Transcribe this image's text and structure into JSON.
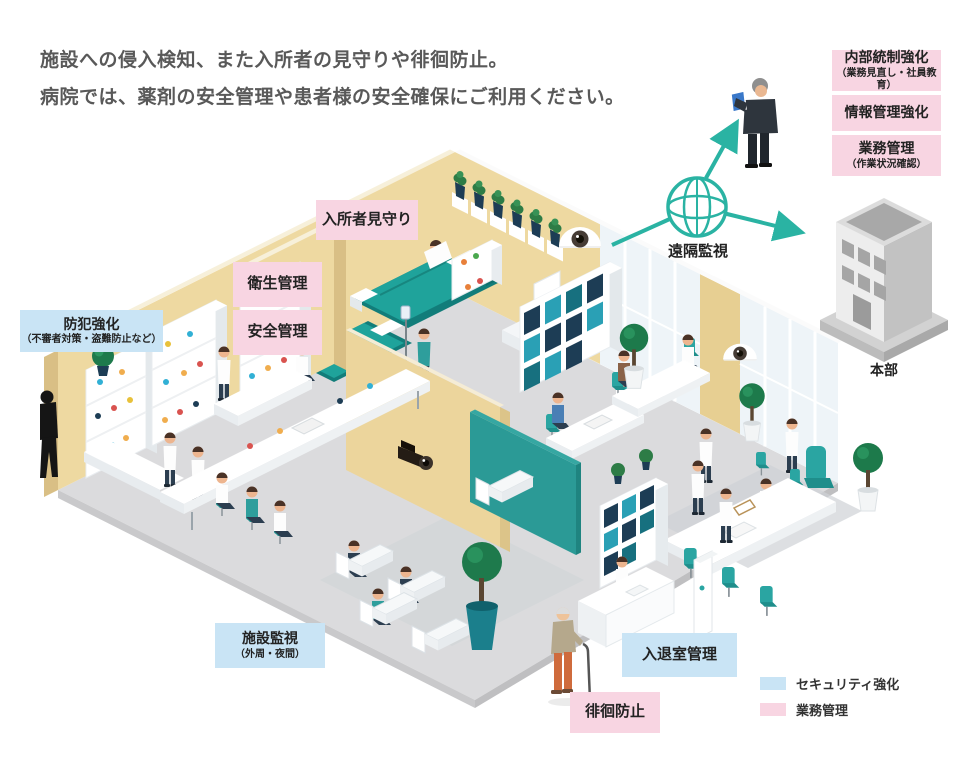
{
  "intro": {
    "line1": "施設への侵入検知、また入所者の見守りや徘徊防止。",
    "line2": "病院では、薬剤の安全管理や患者様の安全確保にご利用ください。"
  },
  "remote_monitoring": {
    "label": "遠隔監視"
  },
  "headquarters": {
    "label": "本部",
    "benefits": [
      {
        "title": "内部統制強化",
        "sub": "（業務見直し・社員教育）"
      },
      {
        "title": "情報管理強化",
        "sub": ""
      },
      {
        "title": "業務管理",
        "sub": "（作業状況確認）"
      }
    ]
  },
  "facility_labels": {
    "resident_watch": "入所者見守り",
    "hygiene": "衛生管理",
    "safety": "安全管理",
    "crime_prevention": "防犯強化",
    "crime_prevention_sub": "（不審者対策・盗難防止など）",
    "facility_monitor": "施設監視",
    "facility_monitor_sub": "（外周・夜間）",
    "entry_exit": "入退室管理",
    "wandering_prevention": "徘徊防止"
  },
  "legend": [
    {
      "label": "セキュリティ強化",
      "color": "#c9e4f5",
      "category": "security"
    },
    {
      "label": "業務管理",
      "color": "#f8d5e2",
      "category": "operations"
    }
  ],
  "icons": {
    "globe": "globe-network-icon",
    "cameras": "security-camera-icon",
    "building": "headquarters-building-icon"
  },
  "colors": {
    "accent_teal": "#2ab3a3",
    "label_pink": "#f8d5e2",
    "label_blue": "#c9e4f5",
    "wall_tan": "#eed9a1",
    "furniture_teal": "#2aa5a2"
  }
}
